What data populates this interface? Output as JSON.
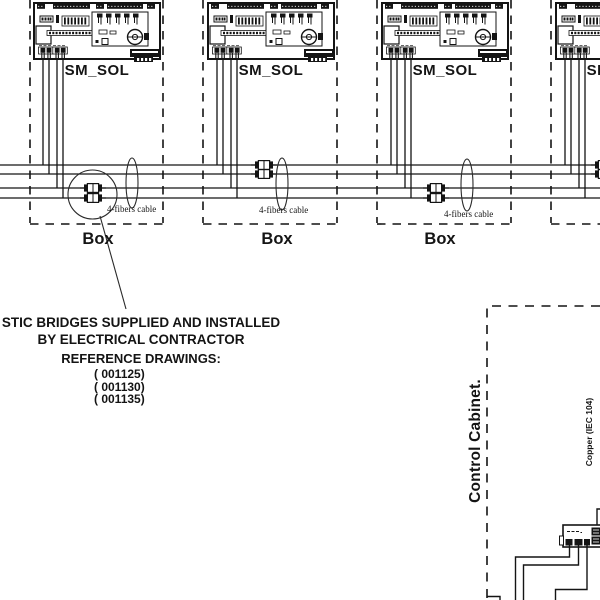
{
  "units": [
    {
      "label": "SM_SOL"
    },
    {
      "label": "SM_SOL"
    },
    {
      "label": "SM_SOL"
    },
    {
      "label": "SM_SOL"
    }
  ],
  "boxes": [
    {
      "label": "Box"
    },
    {
      "label": "Box"
    },
    {
      "label": "Box"
    }
  ],
  "cables": [
    {
      "label": "4-fibers cable"
    },
    {
      "label": "4-fibers cable"
    },
    {
      "label": "4-fibers cable"
    }
  ],
  "note": {
    "line1": "STIC BRIDGES SUPPLIED AND INSTALLED",
    "line2": "BY ELECTRICAL CONTRACTOR",
    "line3": "REFERENCE DRAWINGS:",
    "refs": [
      "( 001125)",
      "( 001130)",
      "( 001135)"
    ]
  },
  "cabinet": {
    "label": "Control Cabinet.",
    "copper_label": "Copper (IEC 104)"
  },
  "colors": {
    "ink": "#141414",
    "bg": "#ffffff"
  }
}
